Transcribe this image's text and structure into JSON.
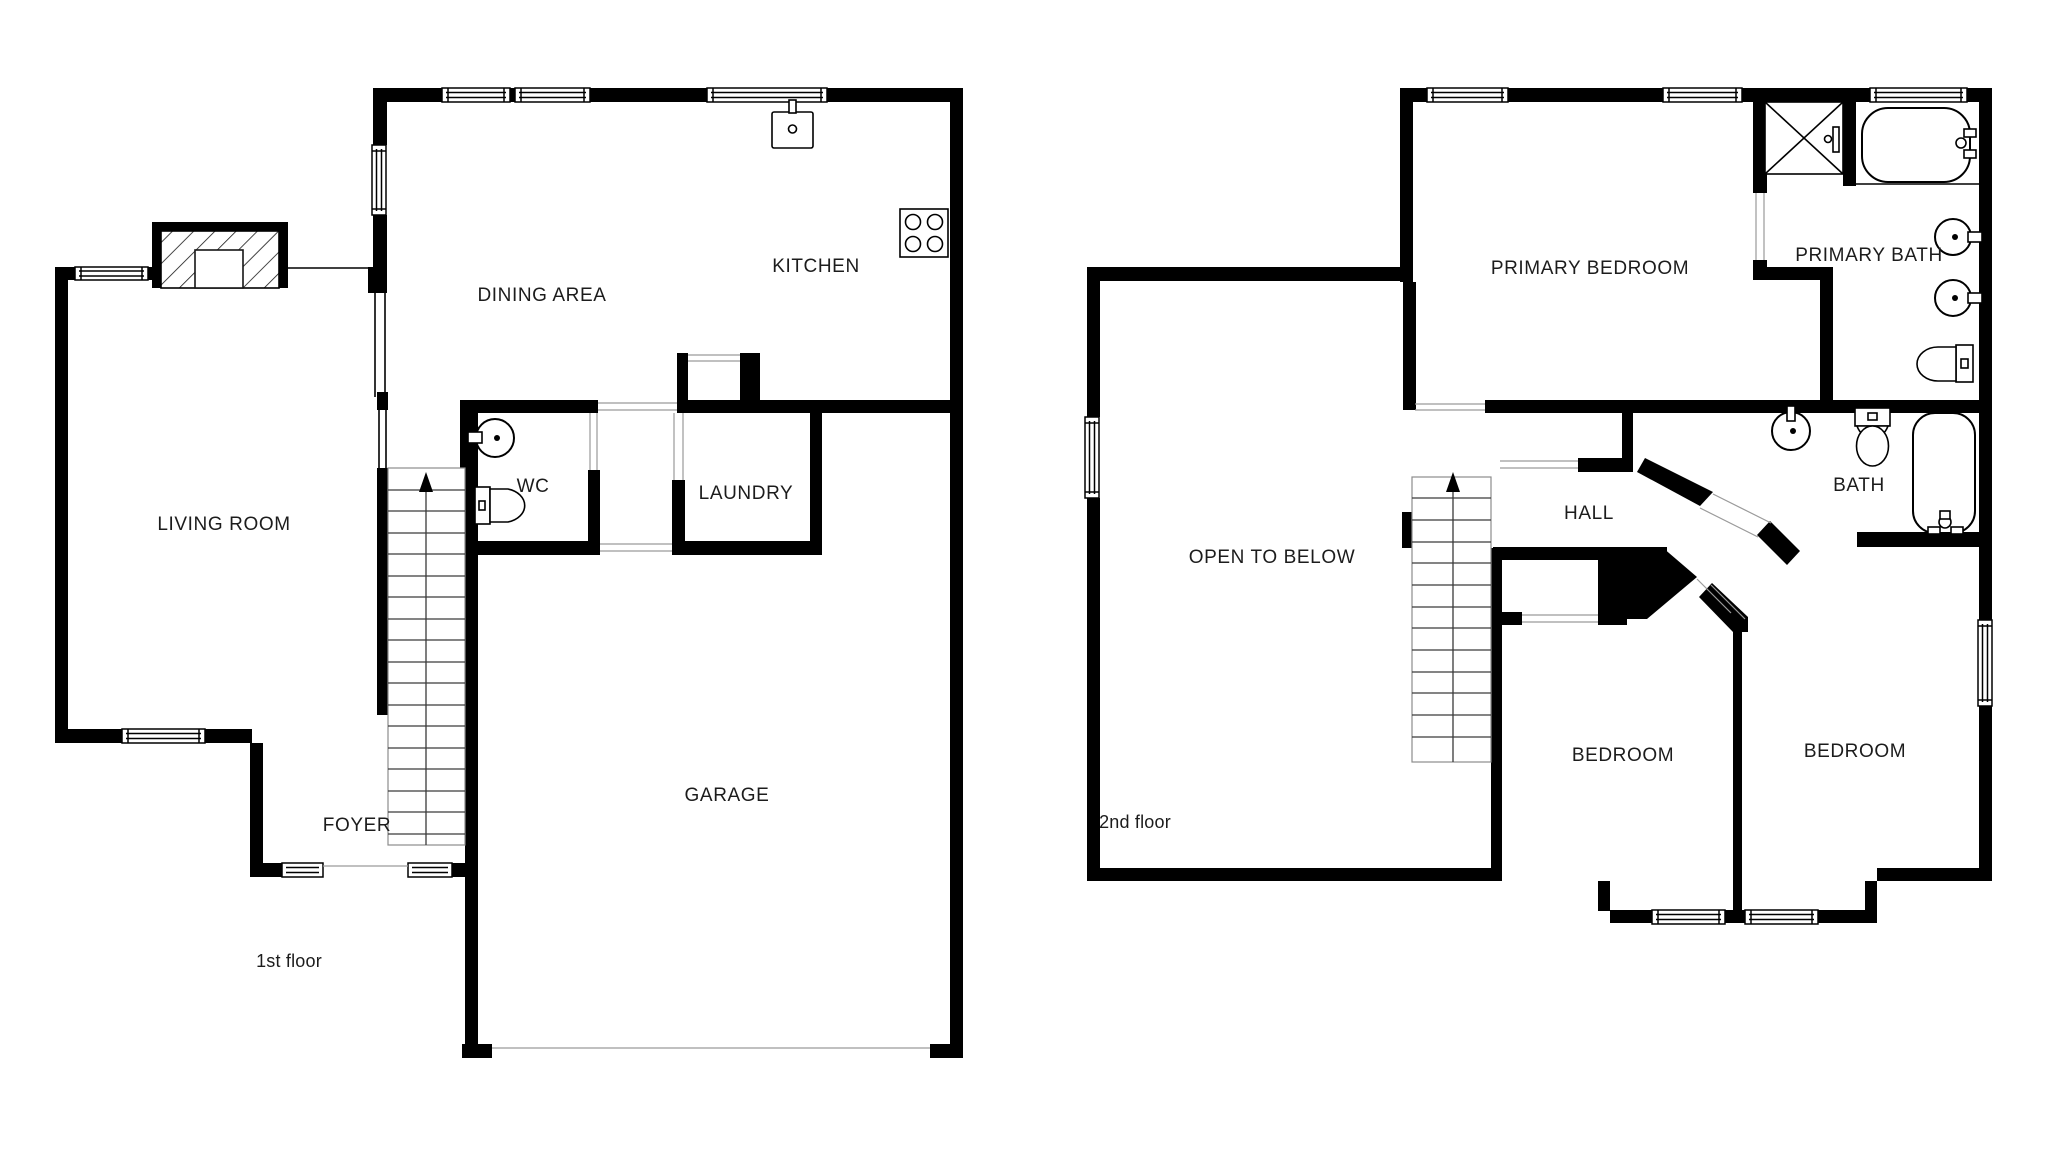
{
  "palette": {
    "background": "#ffffff",
    "wall": "#000000",
    "text": "#1c1c1c"
  },
  "floor1": {
    "label": "1st floor",
    "rooms": {
      "living_room": "LIVING ROOM",
      "dining_area": "DINING AREA",
      "kitchen": "KITCHEN",
      "wc": "WC",
      "laundry": "LAUNDRY",
      "foyer": "FOYER",
      "garage": "GARAGE"
    }
  },
  "floor2": {
    "label": "2nd floor",
    "rooms": {
      "primary_bedroom": "PRIMARY BEDROOM",
      "primary_bath": "PRIMARY BATH",
      "bath": "BATH",
      "hall": "HALL",
      "open_to_below": "OPEN TO BELOW",
      "bedroom_left": "BEDROOM",
      "bedroom_right": "BEDROOM"
    }
  }
}
